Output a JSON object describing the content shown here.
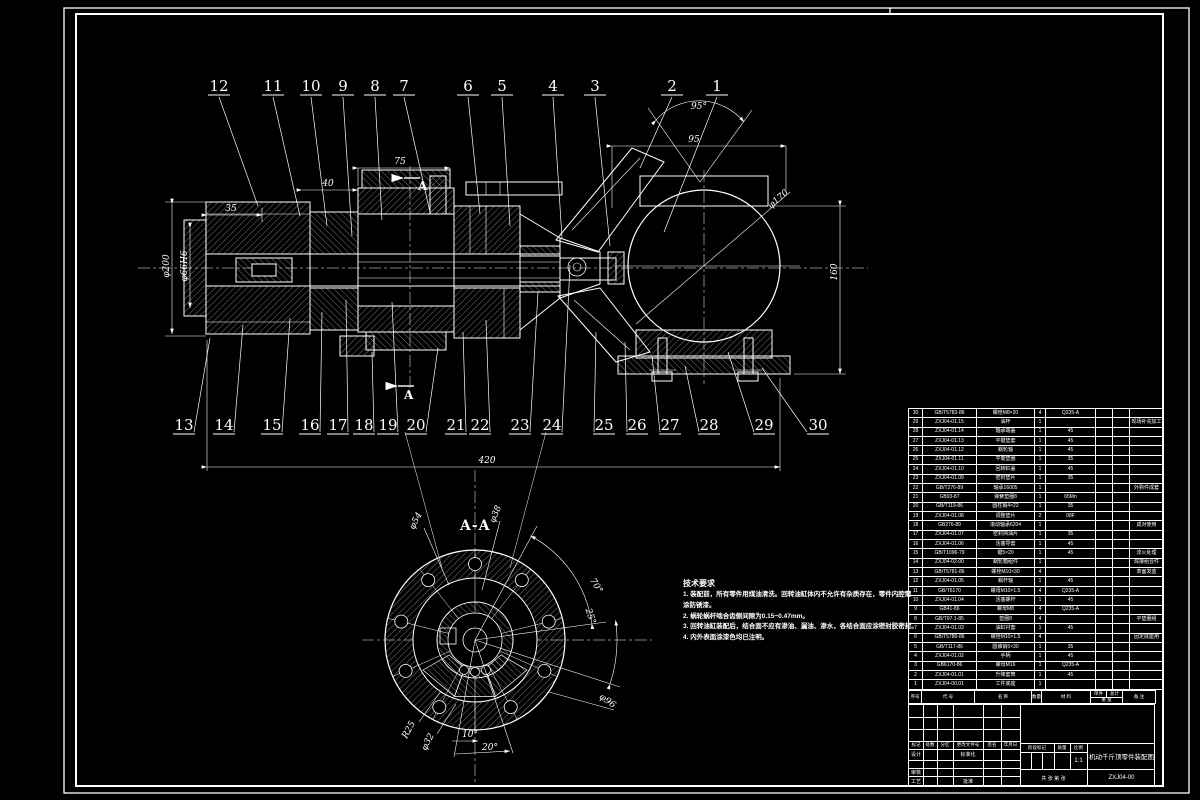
{
  "sheet": {
    "background": "#000000",
    "line_color": "#ffffff"
  },
  "callouts": [
    "1",
    "2",
    "3",
    "4",
    "5",
    "6",
    "7",
    "8",
    "9",
    "10",
    "11",
    "12",
    "13",
    "14",
    "15",
    "16",
    "17",
    "18",
    "19",
    "20",
    "21",
    "22",
    "23",
    "24",
    "25",
    "26",
    "27",
    "28",
    "29",
    "30"
  ],
  "dims": {
    "d420": "420",
    "d95": "95",
    "a95": "95°",
    "d160": "160",
    "d170": "φ170",
    "d75": "75",
    "d40": "40",
    "d35": "35",
    "d200": "φ200",
    "d66": "φ66H6",
    "d38": "φ38",
    "d54": "φ54",
    "d96": "φ96",
    "r25": "R25",
    "d32": "φ32",
    "a10": "10°",
    "a20": "20°",
    "a70": "70°",
    "a25": "25°"
  },
  "section": {
    "label": "A-A",
    "cut": "A"
  },
  "notes": {
    "title": "技术要求",
    "l1": "1. 装配前，所有零件用煤油清洗。回转油缸体内不允许有杂质存在，零件内腔需",
    "l2": "涂防锈漆。",
    "l3": "2. 蜗轮蜗杆啮合齿侧间隙为0.15~0.47mm。",
    "l4": "3. 回转油缸装配后，结合面不应有渗油、漏油、渗水，各结合面应涂密封胶密封。",
    "l5": "4. 内外表面涂漆色均已注明。"
  },
  "bom": {
    "header": {
      "no": "序号",
      "code": "代  号",
      "name": "名  称",
      "qty": "数量",
      "mat": "材  料",
      "unit": "单件",
      "total": "总计",
      "weight": "重  量",
      "remark": "备 注"
    },
    "rows": [
      [
        "30",
        "GB/T5783-86",
        "螺栓M8×20",
        "4",
        "Q235-A",
        ""
      ],
      [
        "29",
        "ZXJ04-01.15",
        "油杯",
        "1",
        "",
        "现场补充加工"
      ],
      [
        "28",
        "ZXJ04-01.14",
        "轴承端盖",
        "1",
        "45",
        ""
      ],
      [
        "27",
        "ZXJ04-01.13",
        "平键垫套",
        "1",
        "45",
        ""
      ],
      [
        "26",
        "ZXJ04-01.12",
        "蜗轮轴",
        "1",
        "45",
        ""
      ],
      [
        "25",
        "ZXJ04-01.11",
        "平衡垫圈",
        "1",
        "35",
        ""
      ],
      [
        "24",
        "ZXJ04-01.10",
        "回转缸盖",
        "1",
        "45",
        ""
      ],
      [
        "23",
        "ZXJ04-01.09",
        "密封垫片",
        "1",
        "35",
        ""
      ],
      [
        "22",
        "GB/T276-89",
        "轴承16005",
        "1",
        "",
        "外购件成套"
      ],
      [
        "21",
        "GB93-87",
        "弹簧垫圈8",
        "1",
        "65Mn",
        ""
      ],
      [
        "20",
        "GB/T119-86",
        "圆柱销4×22",
        "1",
        "35",
        ""
      ],
      [
        "19",
        "ZXJ04-01.08",
        "调整垫片",
        "2",
        "08F",
        ""
      ],
      [
        "18",
        "GB276-89",
        "滚动轴承6204",
        "1",
        "",
        "成对使用"
      ],
      [
        "17",
        "ZXJ04-01.07",
        "密封挡油片",
        "1",
        "35",
        ""
      ],
      [
        "16",
        "ZXJ04-01.06",
        "活塞导套",
        "1",
        "45",
        ""
      ],
      [
        "15",
        "GB/T1096-79",
        "键5×20",
        "1",
        "45",
        "淬火处理"
      ],
      [
        "14",
        "ZXJ04-02-00",
        "蜗轮箱组件",
        "1",
        "",
        "焊接组合件"
      ],
      [
        "13",
        "GB/T5781-86",
        "螺栓M10×30",
        "4",
        "",
        "表面发蓝"
      ],
      [
        "12",
        "ZXJ04-01.05",
        "蜗杆轴",
        "1",
        "45",
        ""
      ],
      [
        "11",
        "GB/T6170",
        "螺母M10×1.5",
        "4",
        "Q235-A",
        ""
      ],
      [
        "10",
        "ZXJ04-01.04",
        "活塞螺杆",
        "1",
        "45",
        ""
      ],
      [
        "9",
        "GB41-86",
        "螺母M8",
        "4",
        "Q235-A",
        ""
      ],
      [
        "8",
        "GB/T97.1-85",
        "垫圈8",
        "4",
        "",
        "平垫圈组"
      ],
      [
        "7",
        "ZXJ04-01.03",
        "油缸衬套",
        "1",
        "45",
        ""
      ],
      [
        "6",
        "GB/T5780-86",
        "螺栓M10×1.5",
        "4",
        "",
        "固定底座用"
      ],
      [
        "5",
        "GB/T117-86",
        "圆锥销5×30",
        "1",
        "35",
        ""
      ],
      [
        "4",
        "ZXJ04-01.02",
        "手柄",
        "1",
        "45",
        ""
      ],
      [
        "3",
        "GB6170-86",
        "螺母M16",
        "1",
        "Q235-A",
        ""
      ],
      [
        "2",
        "ZXJ04-01.01",
        "升降套筒",
        "1",
        "45",
        ""
      ],
      [
        "1",
        "ZXJ04-00.01",
        "工件底座",
        "1",
        "",
        ""
      ]
    ]
  },
  "title_block": {
    "mark": "标记",
    "count": "处数",
    "zone": "分区",
    "change": "更改文件号",
    "sign": "签名",
    "date": "年月日",
    "design": "设计",
    "standard": "标准化",
    "check": "审核",
    "process": "工艺",
    "approve": "批准",
    "stage": "阶段标记",
    "weight": "质量",
    "scale": "比例",
    "scale_value": "1:1",
    "sheet": "共  张  第  张",
    "title": "机动千斤顶零件装配图",
    "number": "ZXJ04-00"
  }
}
